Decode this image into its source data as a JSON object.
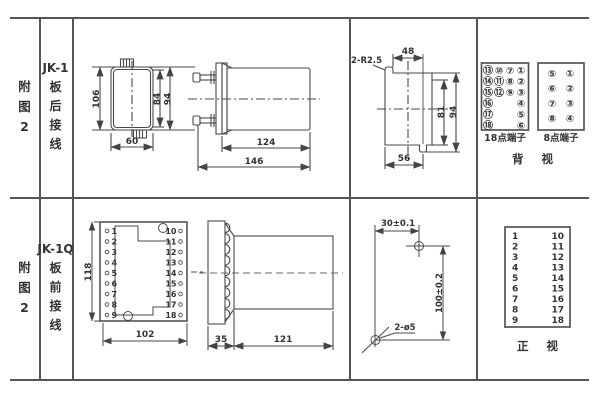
{
  "colors": {
    "table_border": "#555555",
    "drawing_line": "#4a4a4a",
    "text": "#333333",
    "background": "#ffffff"
  },
  "row1": {
    "fig": "附图2",
    "model": "JK-1",
    "wiring": "板后接线",
    "front": {
      "h": "106",
      "w": "60",
      "inner_h": "84",
      "outer_h": "94"
    },
    "side": {
      "body": "124",
      "total": "146"
    },
    "cutout": {
      "radius": "2-R2.5",
      "top_w": "48",
      "h1": "81",
      "h2": "94",
      "bottom_w": "56"
    },
    "t18": {
      "label": "18点端子",
      "rows": [
        [
          "⑬",
          "⑩",
          "⑦",
          "①"
        ],
        [
          "⑭",
          "⑪",
          "⑧",
          "②"
        ],
        [
          "⑮",
          "⑫",
          "⑨",
          "③"
        ],
        [
          "⑯",
          "",
          "",
          "④"
        ],
        [
          "⑰",
          "",
          "",
          "⑤"
        ],
        [
          "⑱",
          "",
          "",
          "⑥"
        ]
      ]
    },
    "t8": {
      "label": "8点端子",
      "rows": [
        [
          "⑤",
          "①"
        ],
        [
          "⑥",
          "②"
        ],
        [
          "⑦",
          "③"
        ],
        [
          "⑧",
          "④"
        ]
      ]
    },
    "caption": "背 视"
  },
  "row2": {
    "fig": "附图2",
    "model": "JK-1Q",
    "wiring": "板前接线",
    "front": {
      "h": "118",
      "w": "102",
      "left": [
        "1",
        "2",
        "3",
        "4",
        "5",
        "6",
        "7",
        "8",
        "9"
      ],
      "right": [
        "10",
        "11",
        "12",
        "13",
        "14",
        "15",
        "16",
        "17",
        "18"
      ]
    },
    "side": {
      "plate": "35",
      "body": "121"
    },
    "drill": {
      "x": "30±0.1",
      "y": "100±0.2",
      "holes": "2-ø5"
    },
    "table": {
      "left": [
        "1",
        "2",
        "3",
        "4",
        "5",
        "6",
        "7",
        "8",
        "9"
      ],
      "right": [
        "10",
        "11",
        "12",
        "13",
        "14",
        "15",
        "16",
        "17",
        "18"
      ]
    },
    "caption": "正 视"
  }
}
